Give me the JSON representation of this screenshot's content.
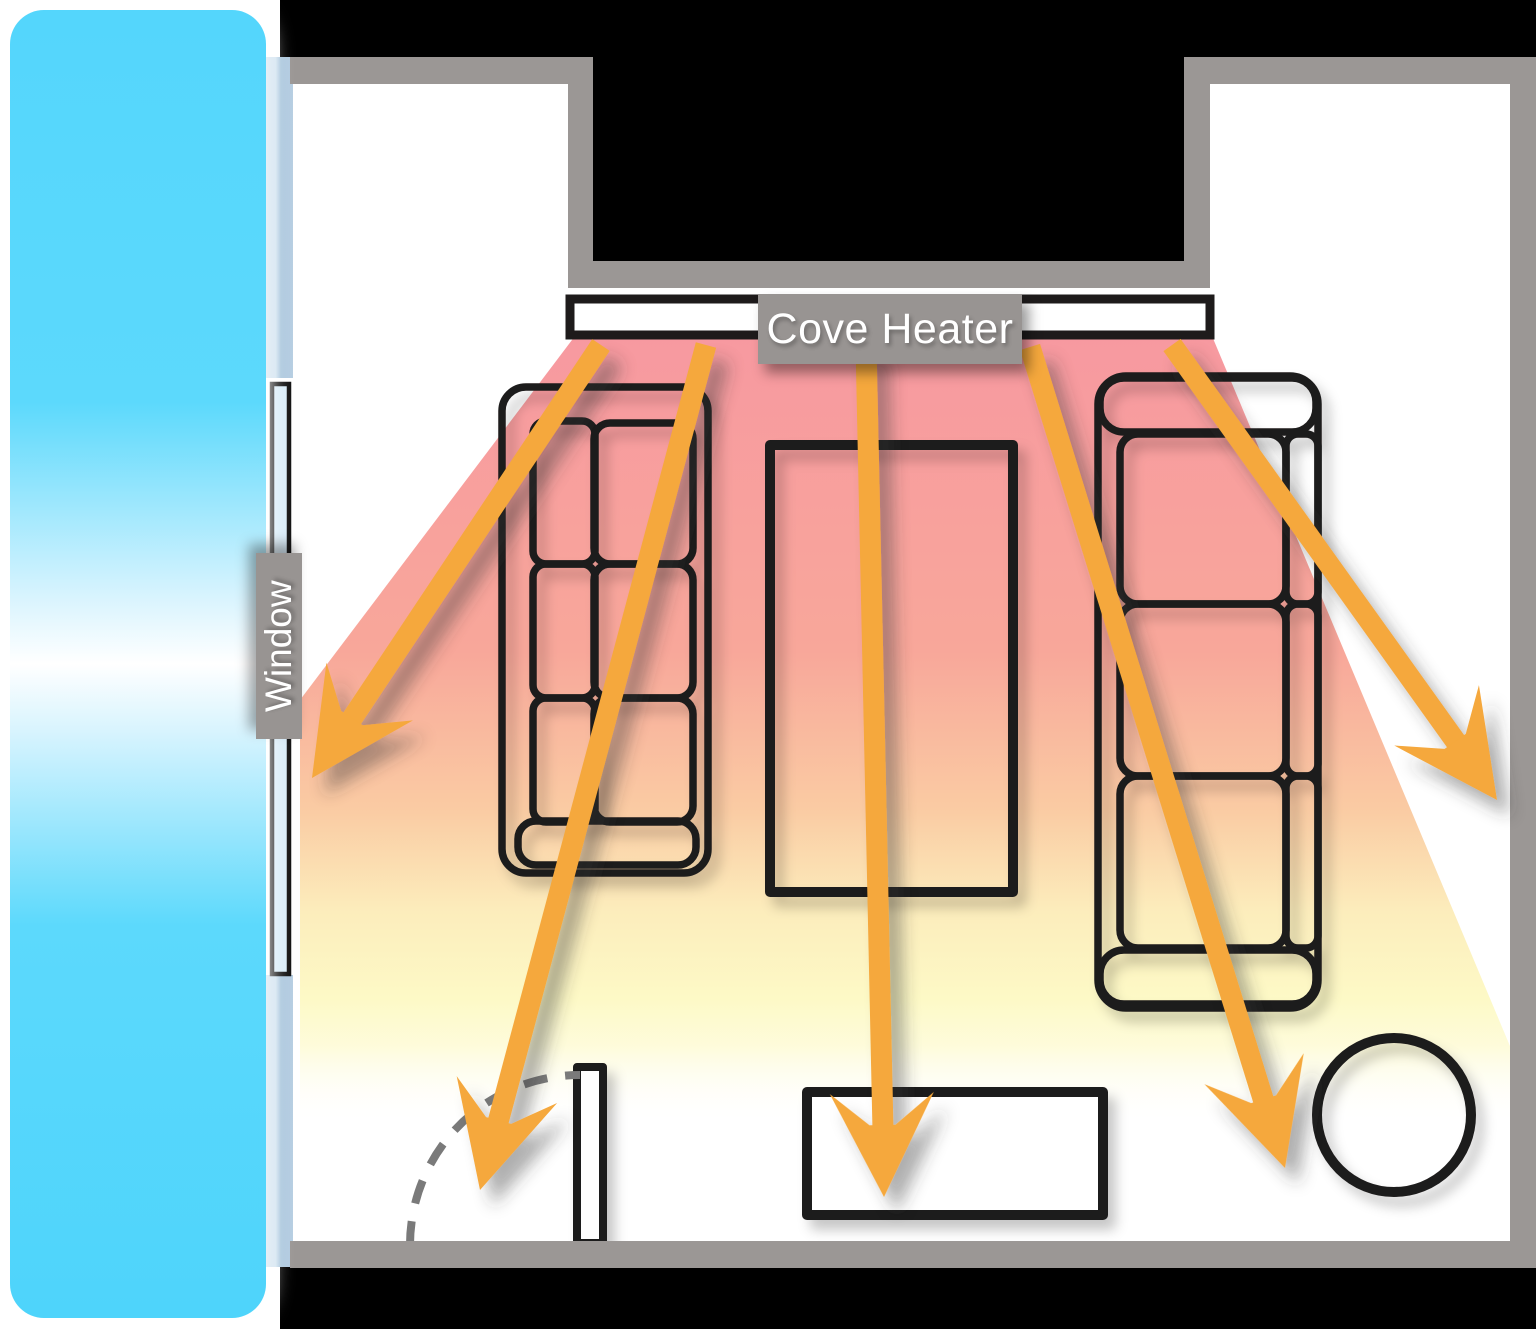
{
  "labels": {
    "cove_heater": "Cove Heater",
    "window": "Window"
  },
  "diagram": {
    "type": "floor-plan-heating-diagram",
    "elements": [
      "cold-air-column",
      "window-glass",
      "window-frame",
      "exterior-area",
      "room-walls",
      "cove-heater-unit",
      "radiant-heat-zone",
      "heat-ray-arrows",
      "sofa-left",
      "sofa-right",
      "coffee-table",
      "media-console",
      "round-table",
      "door-leaf",
      "door-swing-arc"
    ],
    "heat_arrow_count": 5,
    "colors": {
      "outside_black": "#000000",
      "wall_gray": "#9B9795",
      "label_gray": "#989492",
      "cold_air_cyan": "#55D7FC",
      "window_frame_blue": "#B7CEE2",
      "window_glass_blue": "#D8ECF8",
      "heat_warm_pink": "#F799A0",
      "heat_mid_peach": "#FACBA3",
      "heat_cool_yellow": "#FDF9C6",
      "arrow_orange": "#F5A83C",
      "furniture_outline": "#1E1B1B",
      "door_arc_gray": "#7A7A7A",
      "floor_white": "#FFFFFF"
    }
  }
}
